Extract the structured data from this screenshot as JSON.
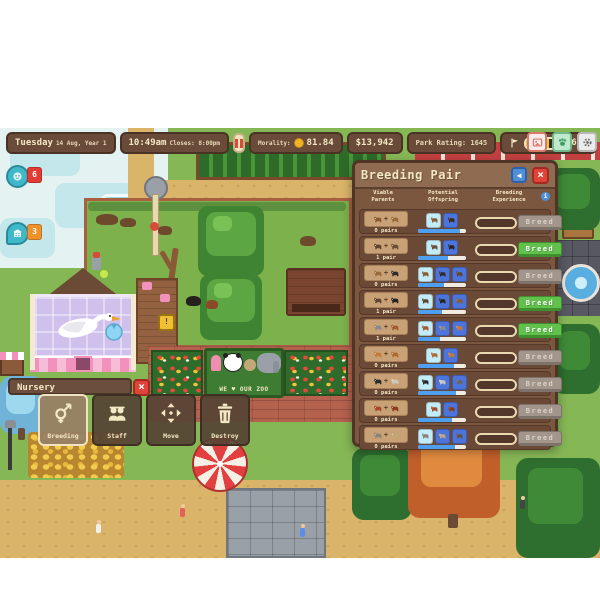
{
  "hud": {
    "date": {
      "day": "Tuesday",
      "date_line": "14 Aug, Year 1"
    },
    "time": {
      "current": "10:49am",
      "closes": "Closes: 8:00pm"
    },
    "morality": {
      "label": "Morality:",
      "value": "81.84"
    },
    "money": "$13,942",
    "park_rating": "Park Rating: 1645",
    "rating_progress": {
      "value": "696",
      "fill_pct": 58
    },
    "guest_count": "16",
    "quick_icons": [
      {
        "name": "screenshot-icon",
        "accent": "#d87a6a"
      },
      {
        "name": "paw-zoopedia-icon",
        "accent": "#3f9e63"
      },
      {
        "name": "settings-gear-icon",
        "accent": "#6a6a6a"
      }
    ],
    "pause_icon": "pause-bars"
  },
  "map_markers": [
    {
      "icon": "animal-face-marker",
      "count": "6",
      "badge_color": "#e23b34",
      "shape": "round"
    },
    {
      "icon": "building-marker",
      "count": "3",
      "badge_color": "#f0922b",
      "shape": "drop"
    }
  ],
  "breeding_panel": {
    "title": "Breeding Pair",
    "columns": [
      "Viable\nParents",
      "Potential\nOffspring",
      "Breeding\nExperience"
    ],
    "info_icon": "i",
    "back_icon": "◀",
    "close_icon": "×",
    "breed_label": "Breed",
    "rows": [
      {
        "pairs": "0 pairs",
        "can_breed": false,
        "diversity_pct": 88,
        "parent_colors": [
          "#8a5a32",
          "#9a6a3a"
        ],
        "offspring": [
          {
            "bg": "#c2ecf7",
            "color": "#8a5a32"
          },
          {
            "bg": "#4d74da",
            "color": "#3a2a1a"
          }
        ]
      },
      {
        "pairs": "1 pair",
        "can_breed": true,
        "diversity_pct": 62,
        "parent_colors": [
          "#5f4430",
          "#6b4e36"
        ],
        "offspring": [
          {
            "bg": "#c2ecf7",
            "color": "#6b4e36"
          },
          {
            "bg": "#4d74da",
            "color": "#262220"
          }
        ]
      },
      {
        "pairs": "0 pairs",
        "can_breed": false,
        "diversity_pct": 55,
        "parent_colors": [
          "#9a6a3a",
          "#2e2a28"
        ],
        "offspring": [
          {
            "bg": "#c2ecf7",
            "color": "#8a5a32"
          },
          {
            "bg": "#4d74da",
            "color": "#2e2a28"
          },
          {
            "bg": "#4d74da",
            "color": "#5f4430"
          }
        ]
      },
      {
        "pairs": "1 pair",
        "can_breed": true,
        "diversity_pct": 50,
        "parent_colors": [
          "#5f4430",
          "#262220"
        ],
        "offspring": [
          {
            "bg": "#c2ecf7",
            "color": "#5f4430"
          },
          {
            "bg": "#4d74da",
            "color": "#262220"
          },
          {
            "bg": "#4d74da",
            "color": "#8a5a32"
          }
        ]
      },
      {
        "pairs": "1 pair",
        "can_breed": true,
        "diversity_pct": 45,
        "parent_colors": [
          "#8a8a88",
          "#a35a2e"
        ],
        "offspring": [
          {
            "bg": "#c2ecf7",
            "color": "#a35a2e"
          },
          {
            "bg": "#4d74da",
            "color": "#8a8a88"
          },
          {
            "bg": "#4d74da",
            "color": "#c27a3a"
          }
        ]
      },
      {
        "pairs": "0 pairs",
        "can_breed": false,
        "diversity_pct": 75,
        "parent_colors": [
          "#c07a3a",
          "#b06a30"
        ],
        "offspring": [
          {
            "bg": "#c2ecf7",
            "color": "#b06a30"
          },
          {
            "bg": "#4d74da",
            "color": "#c07a3a"
          }
        ]
      },
      {
        "pairs": "0 pairs",
        "can_breed": false,
        "diversity_pct": 80,
        "parent_colors": [
          "#2a2a2a",
          "#cfc8bc"
        ],
        "offspring": [
          {
            "bg": "#c2ecf7",
            "color": "#2a2a2a"
          },
          {
            "bg": "#4d74da",
            "color": "#cfc8bc"
          },
          {
            "bg": "#4d74da",
            "color": "#6a6560"
          }
        ]
      },
      {
        "pairs": "0 pairs",
        "can_breed": false,
        "diversity_pct": 70,
        "parent_colors": [
          "#a34a28",
          "#8a3e20"
        ],
        "offspring": [
          {
            "bg": "#c2ecf7",
            "color": "#a34a28"
          },
          {
            "bg": "#4d74da",
            "color": "#8a3e20"
          }
        ]
      },
      {
        "pairs": "0 pairs",
        "can_breed": false,
        "diversity_pct": 78,
        "parent_colors": [
          "#8a8278",
          "#c2a878"
        ],
        "offspring": [
          {
            "bg": "#c2ecf7",
            "color": "#8a8278"
          },
          {
            "bg": "#4d74da",
            "color": "#c2a878"
          },
          {
            "bg": "#4d74da",
            "color": "#5f5346"
          }
        ]
      }
    ]
  },
  "nursery_panel": {
    "title": "Nursery",
    "close_icon": "×",
    "buttons": [
      {
        "label": "Breeding",
        "icon": "gender-breeding-icon",
        "selected": true
      },
      {
        "label": "Staff",
        "icon": "staff-people-icon",
        "selected": false
      },
      {
        "label": "Move",
        "icon": "move-arrows-icon",
        "selected": false
      },
      {
        "label": "Destroy",
        "icon": "trash-destroy-icon",
        "selected": false
      }
    ]
  },
  "world": {
    "sign_text": "WE ♥ OUR ZOO"
  }
}
